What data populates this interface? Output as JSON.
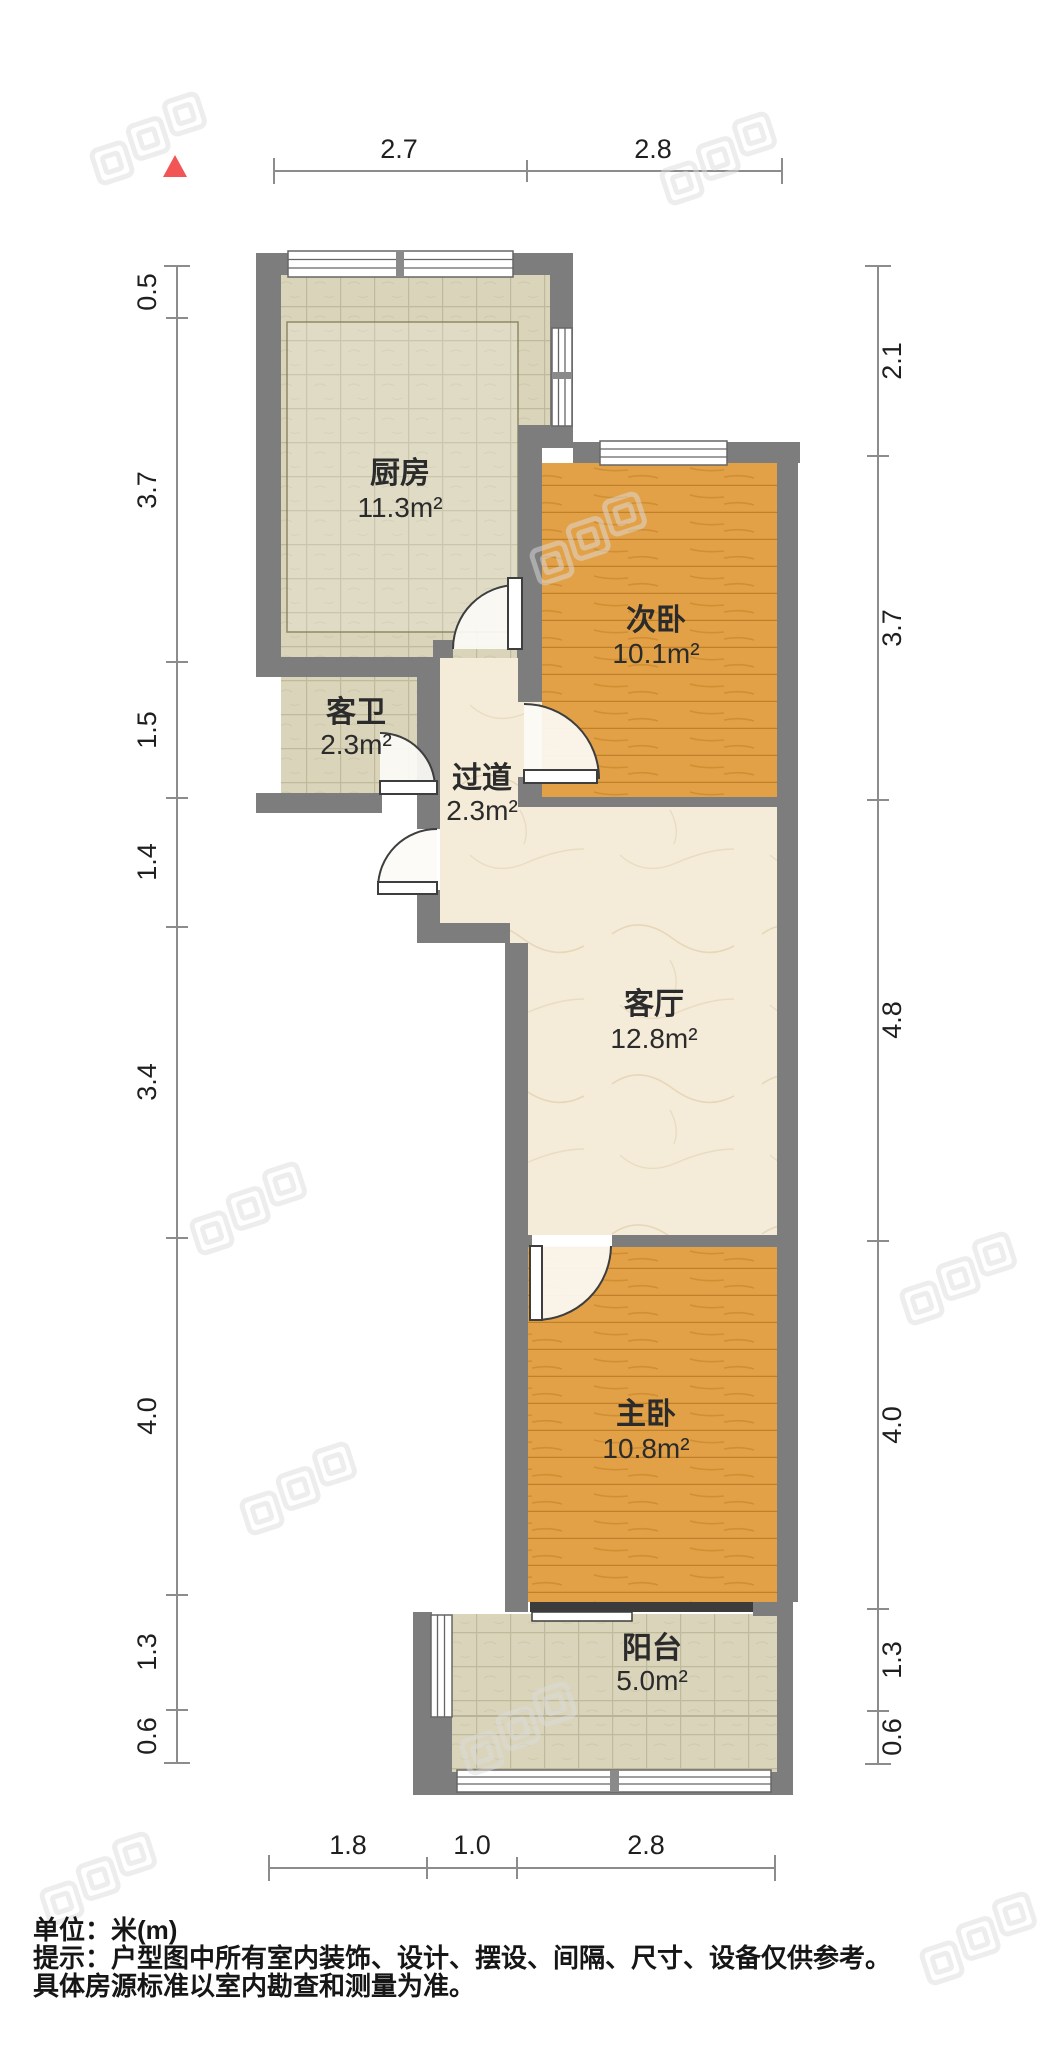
{
  "plan": {
    "rooms": {
      "kitchen": {
        "name": "厨房",
        "area": "11.3m²"
      },
      "guest_bath": {
        "name": "客卫",
        "area": "2.3m²"
      },
      "hallway": {
        "name": "过道",
        "area": "2.3m²"
      },
      "second_bedroom": {
        "name": "次卧",
        "area": "10.1m²"
      },
      "living_room": {
        "name": "客厅",
        "area": "12.8m²"
      },
      "master_bedroom": {
        "name": "主卧",
        "area": "10.8m²"
      },
      "balcony": {
        "name": "阳台",
        "area": "5.0m²"
      }
    },
    "dimensions": {
      "top": [
        "2.7",
        "2.8"
      ],
      "left": [
        "0.5",
        "3.7",
        "1.5",
        "1.4",
        "3.4",
        "4.0",
        "1.3",
        "0.6"
      ],
      "right": [
        "2.1",
        "3.7",
        "4.8",
        "4.0",
        "1.3",
        "0.6"
      ],
      "bottom": [
        "1.8",
        "1.0",
        "2.8"
      ]
    },
    "unit_meters": "m"
  },
  "footer": {
    "unit": "单位：米(m)",
    "tip": "提示：户型图中所有室内装饰、设计、摆设、间隔、尺寸、设备仅供参考。",
    "tip2": "具体房源标准以室内勘查和测量为准。"
  },
  "colors": {
    "wall": "#7d7d7d",
    "tile_floor": "#d9d4ba",
    "wood_floor": "#e2a147",
    "marble_floor": "#f4ecd9",
    "north_indicator": "#f15555"
  }
}
